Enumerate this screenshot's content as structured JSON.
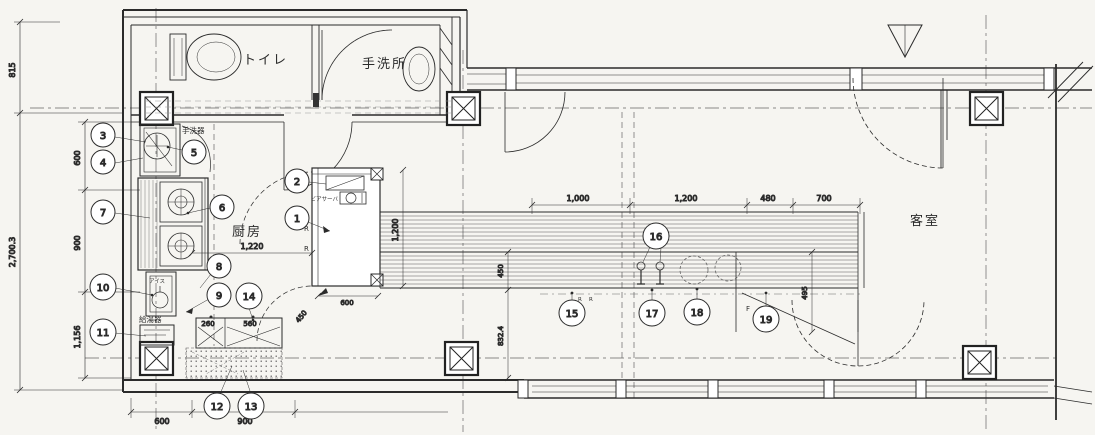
{
  "colors": {
    "paper": "#f6f5f1",
    "ink": "#2b2b2b",
    "ink_light": "#6a6a6a"
  },
  "rooms": {
    "toilet": "トイレ",
    "washroom": "手洗所",
    "kitchen": "厨房",
    "guest_room": "客室"
  },
  "equipment": {
    "hand_wash": "手洗器",
    "water_heater": "給湯器",
    "ice": "アイス",
    "beer": "ビアサーバ"
  },
  "marks": {
    "r": "R",
    "f": "F"
  },
  "callouts": {
    "c1": "1",
    "c2": "2",
    "c3": "3",
    "c4": "4",
    "c5": "5",
    "c6": "6",
    "c7": "7",
    "c8": "8",
    "c9": "9",
    "c10": "10",
    "c11": "11",
    "c12": "12",
    "c13": "13",
    "c14": "14",
    "c15": "15",
    "c16": "16",
    "c17": "17",
    "c18": "18",
    "c19": "19"
  },
  "dimensions": {
    "left_far": {
      "top": "815",
      "total": "2,700.3"
    },
    "left_chain": {
      "d1": "600",
      "d2": "900",
      "d3": "1,156"
    },
    "bottom_chain": {
      "d1": "600",
      "d2": "900"
    },
    "kitchen": {
      "width": "1,220",
      "sink_left": "260",
      "sink_right": "560",
      "door_diag": "450",
      "pass": "600",
      "depth": "832.4"
    },
    "counter": {
      "block_height": "1,200",
      "left_depth": "450",
      "right_depth": "495",
      "chain": {
        "d1": "1,000",
        "d2": "1,200",
        "d3": "480",
        "d4": "700"
      }
    }
  }
}
